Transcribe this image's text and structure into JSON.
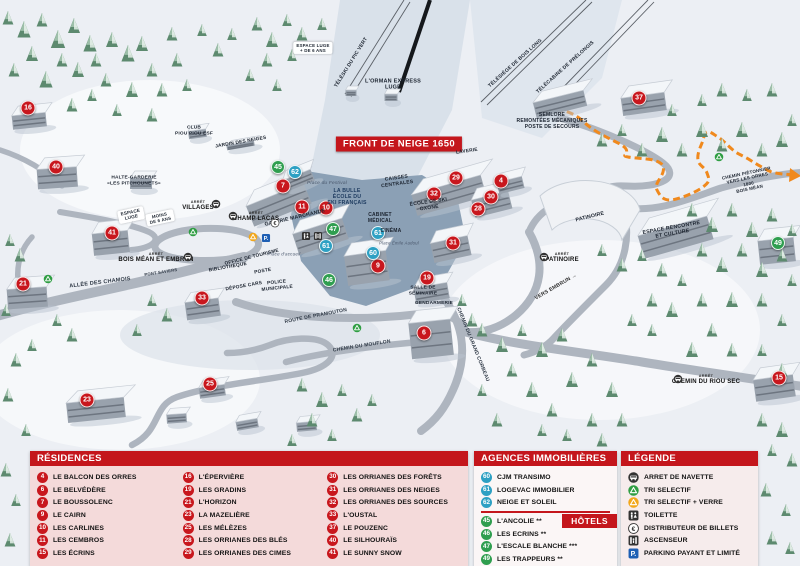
{
  "banner": {
    "text": "FRONT DE NEIGE 1650"
  },
  "colors": {
    "header_red": "#c4161c",
    "marker_red": "#c8171d",
    "marker_blue": "#2da0c3",
    "marker_green": "#2f9e4f",
    "parking_blue": "#1e5fb4",
    "path_orange": "#f0891d"
  },
  "map": {
    "markers": [
      {
        "n": "16",
        "kind": "residence",
        "x": 28,
        "y": 108
      },
      {
        "n": "40",
        "kind": "residence",
        "x": 56,
        "y": 167
      },
      {
        "n": "41",
        "kind": "residence",
        "x": 112,
        "y": 233
      },
      {
        "n": "21",
        "kind": "residence",
        "x": 23,
        "y": 284
      },
      {
        "n": "33",
        "kind": "residence",
        "x": 202,
        "y": 298
      },
      {
        "n": "23",
        "kind": "residence",
        "x": 87,
        "y": 400
      },
      {
        "n": "25",
        "kind": "residence",
        "x": 210,
        "y": 384
      },
      {
        "n": "7",
        "kind": "residence",
        "x": 283,
        "y": 186
      },
      {
        "n": "11",
        "kind": "residence",
        "x": 302,
        "y": 207
      },
      {
        "n": "10",
        "kind": "residence",
        "x": 326,
        "y": 208
      },
      {
        "n": "9",
        "kind": "residence",
        "x": 378,
        "y": 266
      },
      {
        "n": "19",
        "kind": "residence",
        "x": 427,
        "y": 278
      },
      {
        "n": "6",
        "kind": "residence",
        "x": 424,
        "y": 333
      },
      {
        "n": "29",
        "kind": "residence",
        "x": 456,
        "y": 178
      },
      {
        "n": "32",
        "kind": "residence",
        "x": 434,
        "y": 194
      },
      {
        "n": "28",
        "kind": "residence",
        "x": 478,
        "y": 209
      },
      {
        "n": "30",
        "kind": "residence",
        "x": 491,
        "y": 197
      },
      {
        "n": "4",
        "kind": "residence",
        "x": 501,
        "y": 181
      },
      {
        "n": "31",
        "kind": "residence",
        "x": 453,
        "y": 243
      },
      {
        "n": "37",
        "kind": "residence",
        "x": 639,
        "y": 98
      },
      {
        "n": "15",
        "kind": "residence",
        "x": 779,
        "y": 378
      },
      {
        "n": "62",
        "kind": "agency",
        "x": 295,
        "y": 172
      },
      {
        "n": "61",
        "kind": "agency",
        "x": 326,
        "y": 246
      },
      {
        "n": "61",
        "kind": "agency",
        "x": 378,
        "y": 233
      },
      {
        "n": "60",
        "kind": "agency",
        "x": 373,
        "y": 253
      },
      {
        "n": "45",
        "kind": "hotel",
        "x": 278,
        "y": 167
      },
      {
        "n": "47",
        "kind": "hotel",
        "x": 333,
        "y": 229
      },
      {
        "n": "46",
        "kind": "hotel",
        "x": 329,
        "y": 280
      },
      {
        "n": "49",
        "kind": "hotel",
        "x": 778,
        "y": 243
      }
    ],
    "labels": [
      {
        "text": "TÉLÉSKI DU PIC VERT",
        "x": 352,
        "y": 63,
        "rot": -58,
        "size": 5
      },
      {
        "text": "L'ORMAN EXPRESS\nLUGE",
        "x": 393,
        "y": 85,
        "size": 5.5
      },
      {
        "text": "TÉLÉSIÈGE DE BOIS LONG",
        "x": 516,
        "y": 64,
        "rot": -42,
        "size": 5
      },
      {
        "text": "TÉLÉCABINE DE PRÉLONGIS",
        "x": 566,
        "y": 68,
        "rot": -42,
        "size": 5
      },
      {
        "text": "SEMLORE\nREMONTÉES MÉCANIQUES\nPOSTE DE SECOURS",
        "x": 552,
        "y": 122,
        "size": 5
      },
      {
        "text": "CLUB\nPIOU PIOU ESF",
        "x": 194,
        "y": 131,
        "size": 4.8
      },
      {
        "text": "JARDIN DES NEIGES",
        "x": 241,
        "y": 143,
        "rot": -10,
        "size": 4.8
      },
      {
        "text": "HALTE-GARDERIE\n«LES PITCHOUNETS»",
        "x": 134,
        "y": 181,
        "size": 4.8
      },
      {
        "text": "ESPACE\nLUGE",
        "x": 131,
        "y": 215,
        "rot": -12,
        "size": 4.6,
        "pill": 1
      },
      {
        "text": "MOINS\nDE 6 ANS",
        "x": 160,
        "y": 218,
        "rot": -12,
        "size": 4.4,
        "pill": 1
      },
      {
        "text": "ESPACE LUGE\n+ DE 6 ANS",
        "x": 313,
        "y": 48,
        "size": 4.4,
        "pill": 1
      },
      {
        "text": "Place du Festival",
        "x": 327,
        "y": 184,
        "size": 4.8,
        "italic": 1,
        "color": "#49566b"
      },
      {
        "text": "LA BULLE\nÉCOLE DU\nSKI FRANÇAIS",
        "x": 347,
        "y": 197,
        "size": 5.2,
        "color": "#1d3a5f"
      },
      {
        "text": "GALERIE MARCHANDE",
        "x": 295,
        "y": 218,
        "rot": -13,
        "size": 5.2
      },
      {
        "text": "CAISSES\nCENTRALES",
        "x": 397,
        "y": 182,
        "rot": -8,
        "size": 5
      },
      {
        "text": "CABINET\nMÉDICAL",
        "x": 380,
        "y": 219,
        "size": 5
      },
      {
        "text": "CINÉMA",
        "x": 391,
        "y": 232,
        "size": 5
      },
      {
        "text": "Place Émile Audoul",
        "x": 399,
        "y": 244,
        "size": 4.2,
        "italic": 1,
        "color": "#49566b"
      },
      {
        "text": "ÉCOLE DE SKI\nOXONE",
        "x": 429,
        "y": 206,
        "rot": -8,
        "size": 5
      },
      {
        "text": "LAVERIE",
        "x": 467,
        "y": 152,
        "rot": -8,
        "size": 4.8
      },
      {
        "text": "SALLE DE\nSÉMINAIRE",
        "x": 423,
        "y": 291,
        "size": 4.8
      },
      {
        "text": "GENDARMERIE",
        "x": 434,
        "y": 304,
        "size": 4.8
      },
      {
        "text": "PATINOIRE",
        "x": 590,
        "y": 217,
        "rot": -14,
        "size": 5.2
      },
      {
        "text": "ESPACE RENCONTRE\nET CULTURE",
        "x": 672,
        "y": 231,
        "rot": -10,
        "size": 5.2
      },
      {
        "text": "VERS EMBRUN →",
        "x": 556,
        "y": 287,
        "rot": -30,
        "size": 5.2,
        "color": "#333333"
      },
      {
        "text": "ALLÉE DES CHAMOIS",
        "x": 100,
        "y": 283,
        "rot": -7,
        "size": 5.5,
        "color": "#2f3946"
      },
      {
        "text": "PONT SAVIERS",
        "x": 161,
        "y": 273,
        "rot": -9,
        "size": 4.2,
        "color": "#2f3946"
      },
      {
        "text": "ROUTE DE PRAMOUTON",
        "x": 316,
        "y": 317,
        "rot": -11,
        "size": 5,
        "color": "#2f3946"
      },
      {
        "text": "CHEMIN DU MOUFLON",
        "x": 362,
        "y": 347,
        "rot": -9,
        "size": 5,
        "color": "#2f3946"
      },
      {
        "text": "CHEMIN DU GRAND CORBEAU",
        "x": 472,
        "y": 345,
        "rot": 68,
        "size": 5,
        "color": "#2f3946"
      },
      {
        "text": "CHEMIN PIÉTONNIER\nVERS LES ORRES 1800\nBOIS MÉAN",
        "x": 748,
        "y": 181,
        "rot": -12,
        "size": 4.5
      },
      {
        "text": "OFFICE DE TOURISME",
        "x": 252,
        "y": 258,
        "rot": -14,
        "size": 4.8
      },
      {
        "text": "BIBLIOTHÈQUE",
        "x": 228,
        "y": 268,
        "rot": -10,
        "size": 4.8
      },
      {
        "text": "POSTE",
        "x": 263,
        "y": 272,
        "rot": -10,
        "size": 4.8
      },
      {
        "text": "DÉPOSE CARS",
        "x": 244,
        "y": 287,
        "rot": -10,
        "size": 4.8
      },
      {
        "text": "POLICE\nMUNICIPALE",
        "x": 277,
        "y": 286,
        "rot": -6,
        "size": 4.8
      },
      {
        "text": "Place d'accueil",
        "x": 284,
        "y": 254,
        "size": 4.5,
        "italic": 1,
        "color": "#49566b"
      }
    ],
    "icons": [
      {
        "icon": "recycle-green",
        "x": 48,
        "y": 279
      },
      {
        "icon": "recycle-green",
        "x": 193,
        "y": 232
      },
      {
        "icon": "recycle-green",
        "x": 357,
        "y": 328
      },
      {
        "icon": "recycle-green",
        "x": 719,
        "y": 157
      },
      {
        "icon": "recycle-yellow",
        "x": 253,
        "y": 237
      },
      {
        "icon": "parking",
        "x": 266,
        "y": 238
      },
      {
        "icon": "euro",
        "x": 275,
        "y": 223
      },
      {
        "icon": "toilet",
        "x": 306,
        "y": 236
      },
      {
        "icon": "elevator",
        "x": 318,
        "y": 236
      }
    ],
    "bus_stops": {
      "prefix": "ARRÊT",
      "stops": [
        {
          "name": "VILLAGES",
          "tx": 198,
          "ty": 206,
          "ix": 216,
          "iy": 204
        },
        {
          "name": "CHAMP LACAS",
          "tx": 256,
          "ty": 217,
          "ix": 233,
          "iy": 216
        },
        {
          "name": "BOIS MÉAN ET EMBRUN",
          "tx": 156,
          "ty": 258,
          "ix": 188,
          "iy": 257
        },
        {
          "name": "PATINOIRE",
          "tx": 562,
          "ty": 258,
          "ix": 544,
          "iy": 257
        },
        {
          "name": "CHEMIN DU RIOU SEC",
          "tx": 706,
          "ty": 380,
          "ix": 678,
          "iy": 379
        }
      ]
    }
  },
  "panels": {
    "residences": {
      "title": "RÉSIDENCES",
      "columns": [
        [
          {
            "n": "4",
            "label": "LE BALCON DES ORRES"
          },
          {
            "n": "6",
            "label": "LE BELVÉDÈRE"
          },
          {
            "n": "7",
            "label": "LE BOUSSOLENC"
          },
          {
            "n": "9",
            "label": "LE CAIRN"
          },
          {
            "n": "10",
            "label": "LES CARLINES"
          },
          {
            "n": "11",
            "label": "LES CEMBROS"
          },
          {
            "n": "15",
            "label": "LES ÉCRINS"
          }
        ],
        [
          {
            "n": "16",
            "label": "L'ÉPERVIÈRE"
          },
          {
            "n": "19",
            "label": "LES GRADINS"
          },
          {
            "n": "21",
            "label": "L'HORIZON"
          },
          {
            "n": "23",
            "label": "LA MAZELIÈRE"
          },
          {
            "n": "25",
            "label": "LES MÉLÈZES"
          },
          {
            "n": "28",
            "label": "LES ORRIANES DES BLÉS"
          },
          {
            "n": "29",
            "label": "LES ORRIANES DES CIMES"
          }
        ],
        [
          {
            "n": "30",
            "label": "LES ORRIANES DES FORÊTS"
          },
          {
            "n": "31",
            "label": "LES ORRIANES DES NEIGES"
          },
          {
            "n": "32",
            "label": "LES ORRIANES DES SOURCES"
          },
          {
            "n": "33",
            "label": "L'OUSTAL"
          },
          {
            "n": "37",
            "label": "LE POUZENC"
          },
          {
            "n": "40",
            "label": "LE SILHOURAÏS"
          },
          {
            "n": "41",
            "label": "LE SUNNY SNOW"
          }
        ]
      ]
    },
    "agences": {
      "title": "AGENCES IMMOBILIÈRES",
      "items": [
        {
          "n": "60",
          "label": "CJM TRANSIMO"
        },
        {
          "n": "61",
          "label": "LOGEVAC IMMOBILIER"
        },
        {
          "n": "62",
          "label": "NEIGE ET SOLEIL"
        }
      ],
      "hotels_title": "HÔTELS",
      "hotels": [
        {
          "n": "45",
          "label": "L'ANCOLIE **"
        },
        {
          "n": "46",
          "label": "LES ECRINS **"
        },
        {
          "n": "47",
          "label": "L'ESCALE BLANCHE ***"
        },
        {
          "n": "49",
          "label": "LES TRAPPEURS **"
        }
      ]
    },
    "legende": {
      "title": "LÉGENDE",
      "items": [
        {
          "icon": "bus",
          "label": "ARRET DE NAVETTE"
        },
        {
          "icon": "recycle-green",
          "label": "TRI SELECTIF"
        },
        {
          "icon": "recycle-yellow",
          "label": "TRI SELECTIF + VERRE"
        },
        {
          "icon": "toilet",
          "label": "TOILETTE"
        },
        {
          "icon": "euro",
          "label": "DISTRIBUTEUR DE BILLETS"
        },
        {
          "icon": "elevator",
          "label": "ASCENSEUR"
        },
        {
          "icon": "parking",
          "label": "PARKING PAYANT ET LIMITÉ"
        }
      ]
    }
  }
}
